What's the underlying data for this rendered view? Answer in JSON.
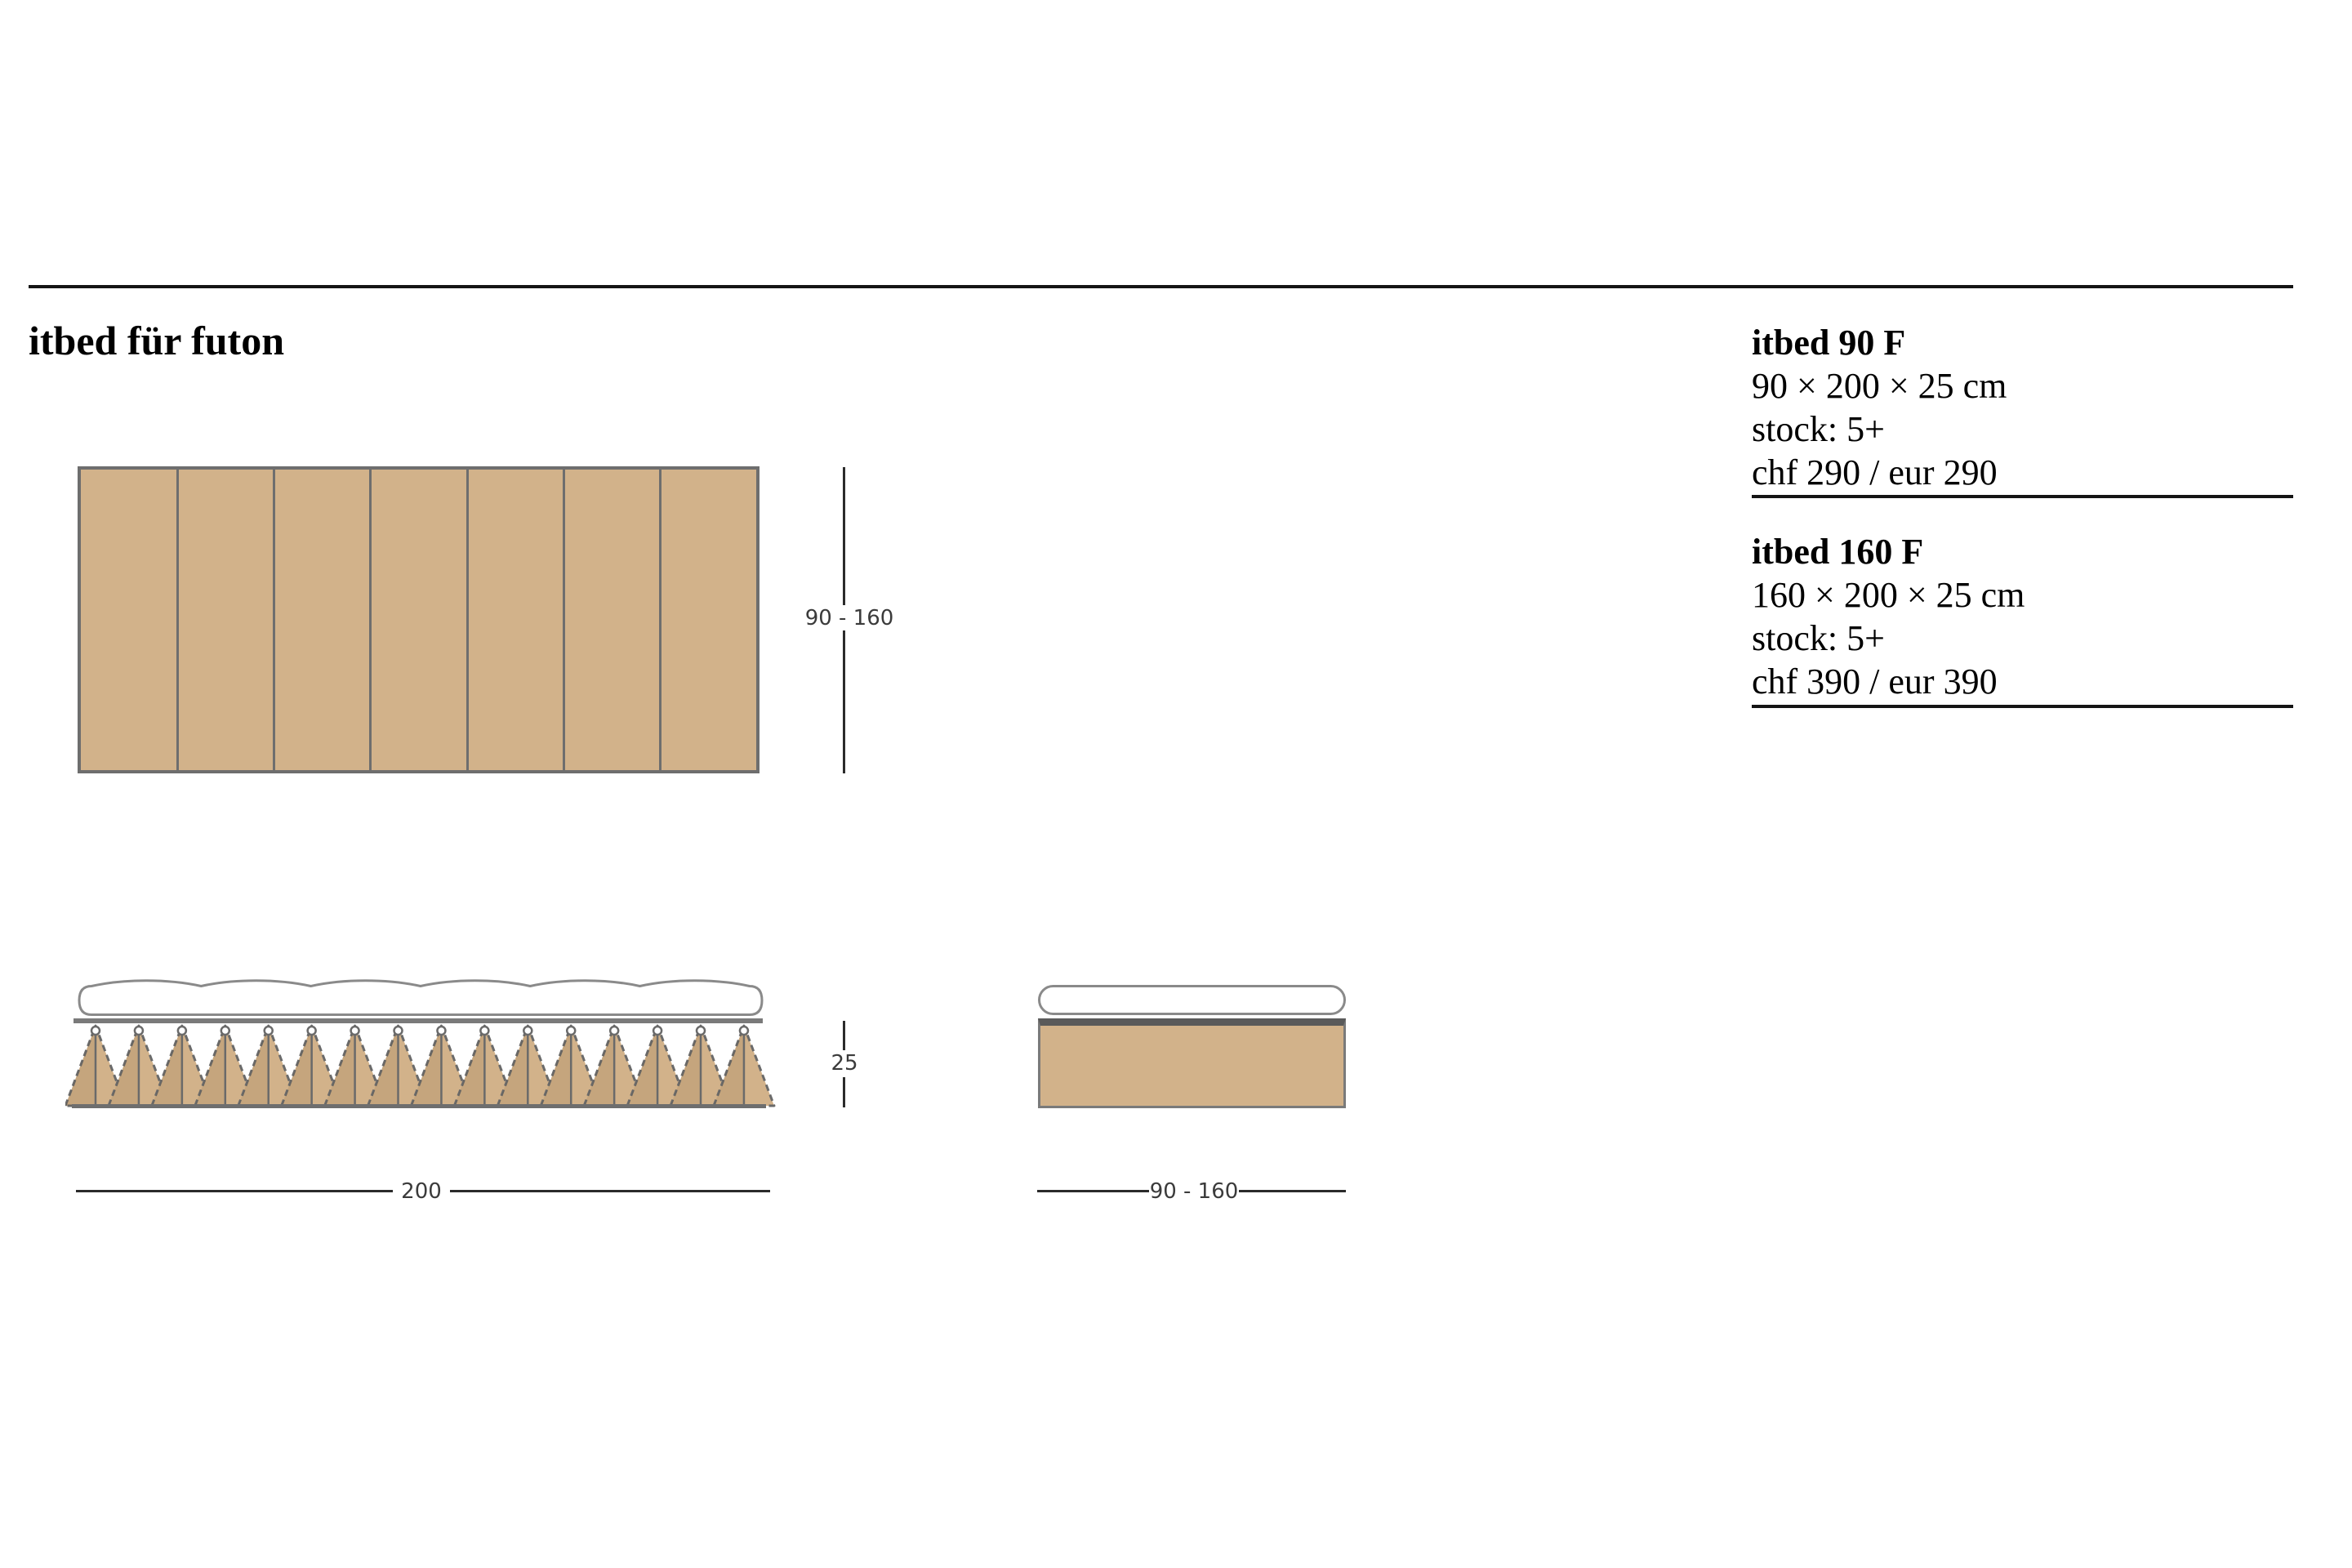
{
  "page": {
    "title": "itbed für futon"
  },
  "drawing": {
    "top_view_width_label": "90 - 160",
    "thickness_label": "25",
    "length_label": "200",
    "end_view_width_label": "90 - 160",
    "slats_count": 7,
    "springs_count": 16,
    "colors": {
      "wood_tan": "#d2b28a",
      "outline_gray": "#6a6a6a",
      "frame_gray": "#6e6e6e",
      "mattress_gray": "#8a8a8a",
      "dimension_line": "#2b2b2b",
      "dimension_text": "#3b3b3b",
      "rule_black": "#141414"
    }
  },
  "products": [
    {
      "name": "itbed 90 F",
      "dimensions": "90 × 200 × 25 cm",
      "stock": "stock: 5+",
      "price": "chf 290 / eur 290"
    },
    {
      "name": "itbed 160 F",
      "dimensions": "160 × 200 × 25 cm",
      "stock": "stock: 5+",
      "price": "chf 390 / eur 390"
    }
  ]
}
